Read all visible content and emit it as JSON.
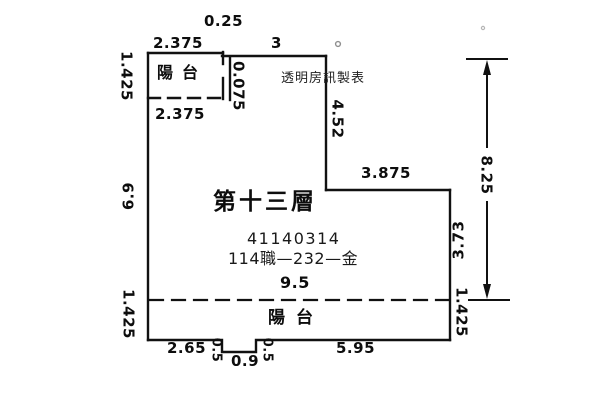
{
  "floor": {
    "title": "第十三層",
    "serial": "41140314",
    "code": "114職—232—金",
    "watermark": "透明房訊製表"
  },
  "balcony_top_label": "陽台",
  "balcony_bottom_label": "陽台",
  "dims": {
    "top_step": "0.25",
    "top_balcony_width": "2.375",
    "top_main_width": "3",
    "balcony_depth_top_left": "1.425",
    "balcony_inner_width": "2.375",
    "wall_offset": "0.075",
    "right_upper": "4.52",
    "left_main": "6.9",
    "mid_width": "3.875",
    "right_mid": "3.73",
    "right_total": "8.25",
    "interior_width": "9.5",
    "balcony_depth_bottom_left": "1.425",
    "balcony_depth_bottom_right": "1.425",
    "bottom_left": "2.65",
    "notch_depth_left": "0.5",
    "notch_width": "0.9",
    "notch_depth_right": "0.5",
    "bottom_right": "5.95"
  }
}
